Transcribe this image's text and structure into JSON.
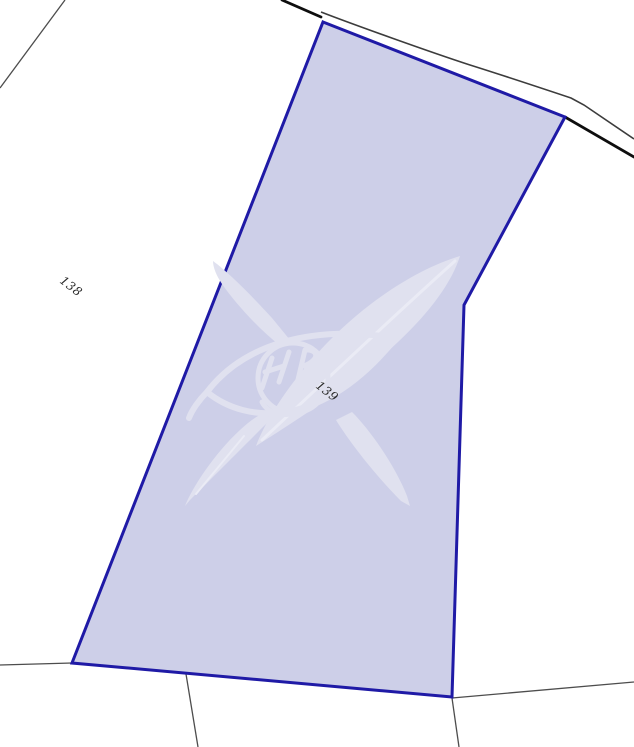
{
  "map": {
    "type": "cadastral-sketch",
    "parcels": [
      {
        "id": "138",
        "label": "138",
        "selected": false
      },
      {
        "id": "139",
        "label": "139",
        "selected": true
      }
    ],
    "selected_parcel": "139"
  },
  "colors": {
    "background": "#ffffff",
    "parcel_fill": "#cdcfe8",
    "parcel_border": "#1f1aa6",
    "road_edge_dark": "#0e0e0e",
    "road_edge_light": "#3c3c3c",
    "boundary_gray": "#4d4d4d",
    "watermark": "#e0e1ef",
    "watermark_highlight": "#eaebf5",
    "label_text": "#2a2a2a"
  },
  "watermark": {
    "name": "agency-logo-watermark",
    "description_glyphs": [
      "crossed-quill-feathers",
      "eye-lens-outline",
      "monogram-sphere"
    ]
  }
}
